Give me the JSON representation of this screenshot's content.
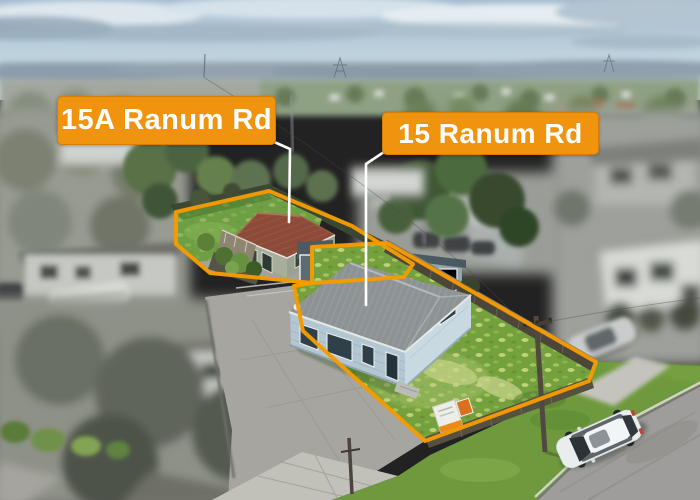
{
  "annotations": {
    "labels": [
      {
        "id": "15a",
        "text": "15A Ranum Rd"
      },
      {
        "id": "15",
        "text": "15 Ranum Rd"
      }
    ],
    "colors": {
      "label_background": "#F0930E",
      "label_text": "#FFFFFF",
      "boundary_outline": "#F59B00",
      "leader_line": "#FFFFFF"
    }
  }
}
